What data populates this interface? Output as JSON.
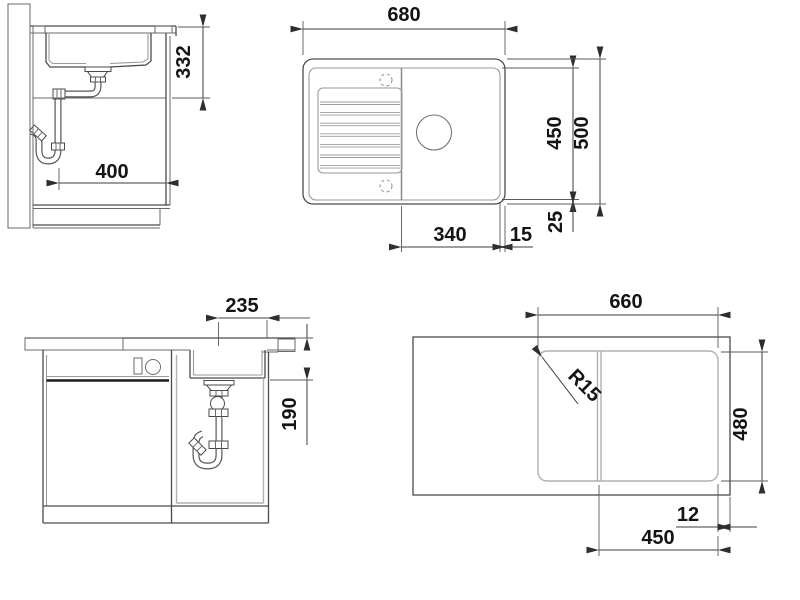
{
  "drawing_type": "sink installation drawing",
  "views": {
    "side_section": {
      "dim_clearance_height": "332",
      "dim_wall_distance": "400"
    },
    "top_plan": {
      "dim_overall_width": "680",
      "dim_inner_depth": "450",
      "dim_overall_depth": "500",
      "dim_bowl_section_width": "340",
      "dim_edge_gap": "15",
      "dim_rim_gap": "25"
    },
    "front_section": {
      "dim_drain_offset": "235",
      "dim_bowl_depth": "190"
    },
    "cutout_plan": {
      "dim_cutout_width": "660",
      "dim_cutout_depth": "480",
      "dim_corner_radius": "R15",
      "dim_edge_distance": "12",
      "dim_bowl_cutout_width": "450"
    }
  },
  "colors": {
    "background": "#ffffff",
    "main_line": "#4a4a4a",
    "light_line": "#9a9a9a",
    "text": "#141414"
  }
}
